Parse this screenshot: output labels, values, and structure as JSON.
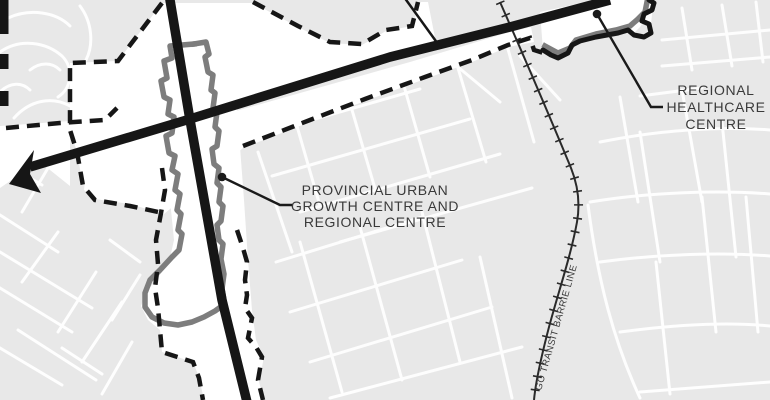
{
  "map": {
    "colors": {
      "background": "#e8e8e8",
      "street": "#ffffff",
      "zone_fill": "#ffffff",
      "road": "#161616",
      "boundary_dashed": "#161616",
      "growth_boundary_gray": "#7d7d7d",
      "rail": "#2a2a2a",
      "label": "#3a3a3a",
      "leader": "#1a1a1a"
    },
    "labels": {
      "growth_centre": {
        "line1": "PROVINCIAL URBAN",
        "line2": "GROWTH CENTRE AND",
        "line3": "REGIONAL CENTRE"
      },
      "healthcare_centre": {
        "line1": "REGIONAL",
        "line2": "HEALTHCARE",
        "line3": "CENTRE"
      },
      "rail_line": "GO TRANSIT BARRIE LINE"
    }
  }
}
